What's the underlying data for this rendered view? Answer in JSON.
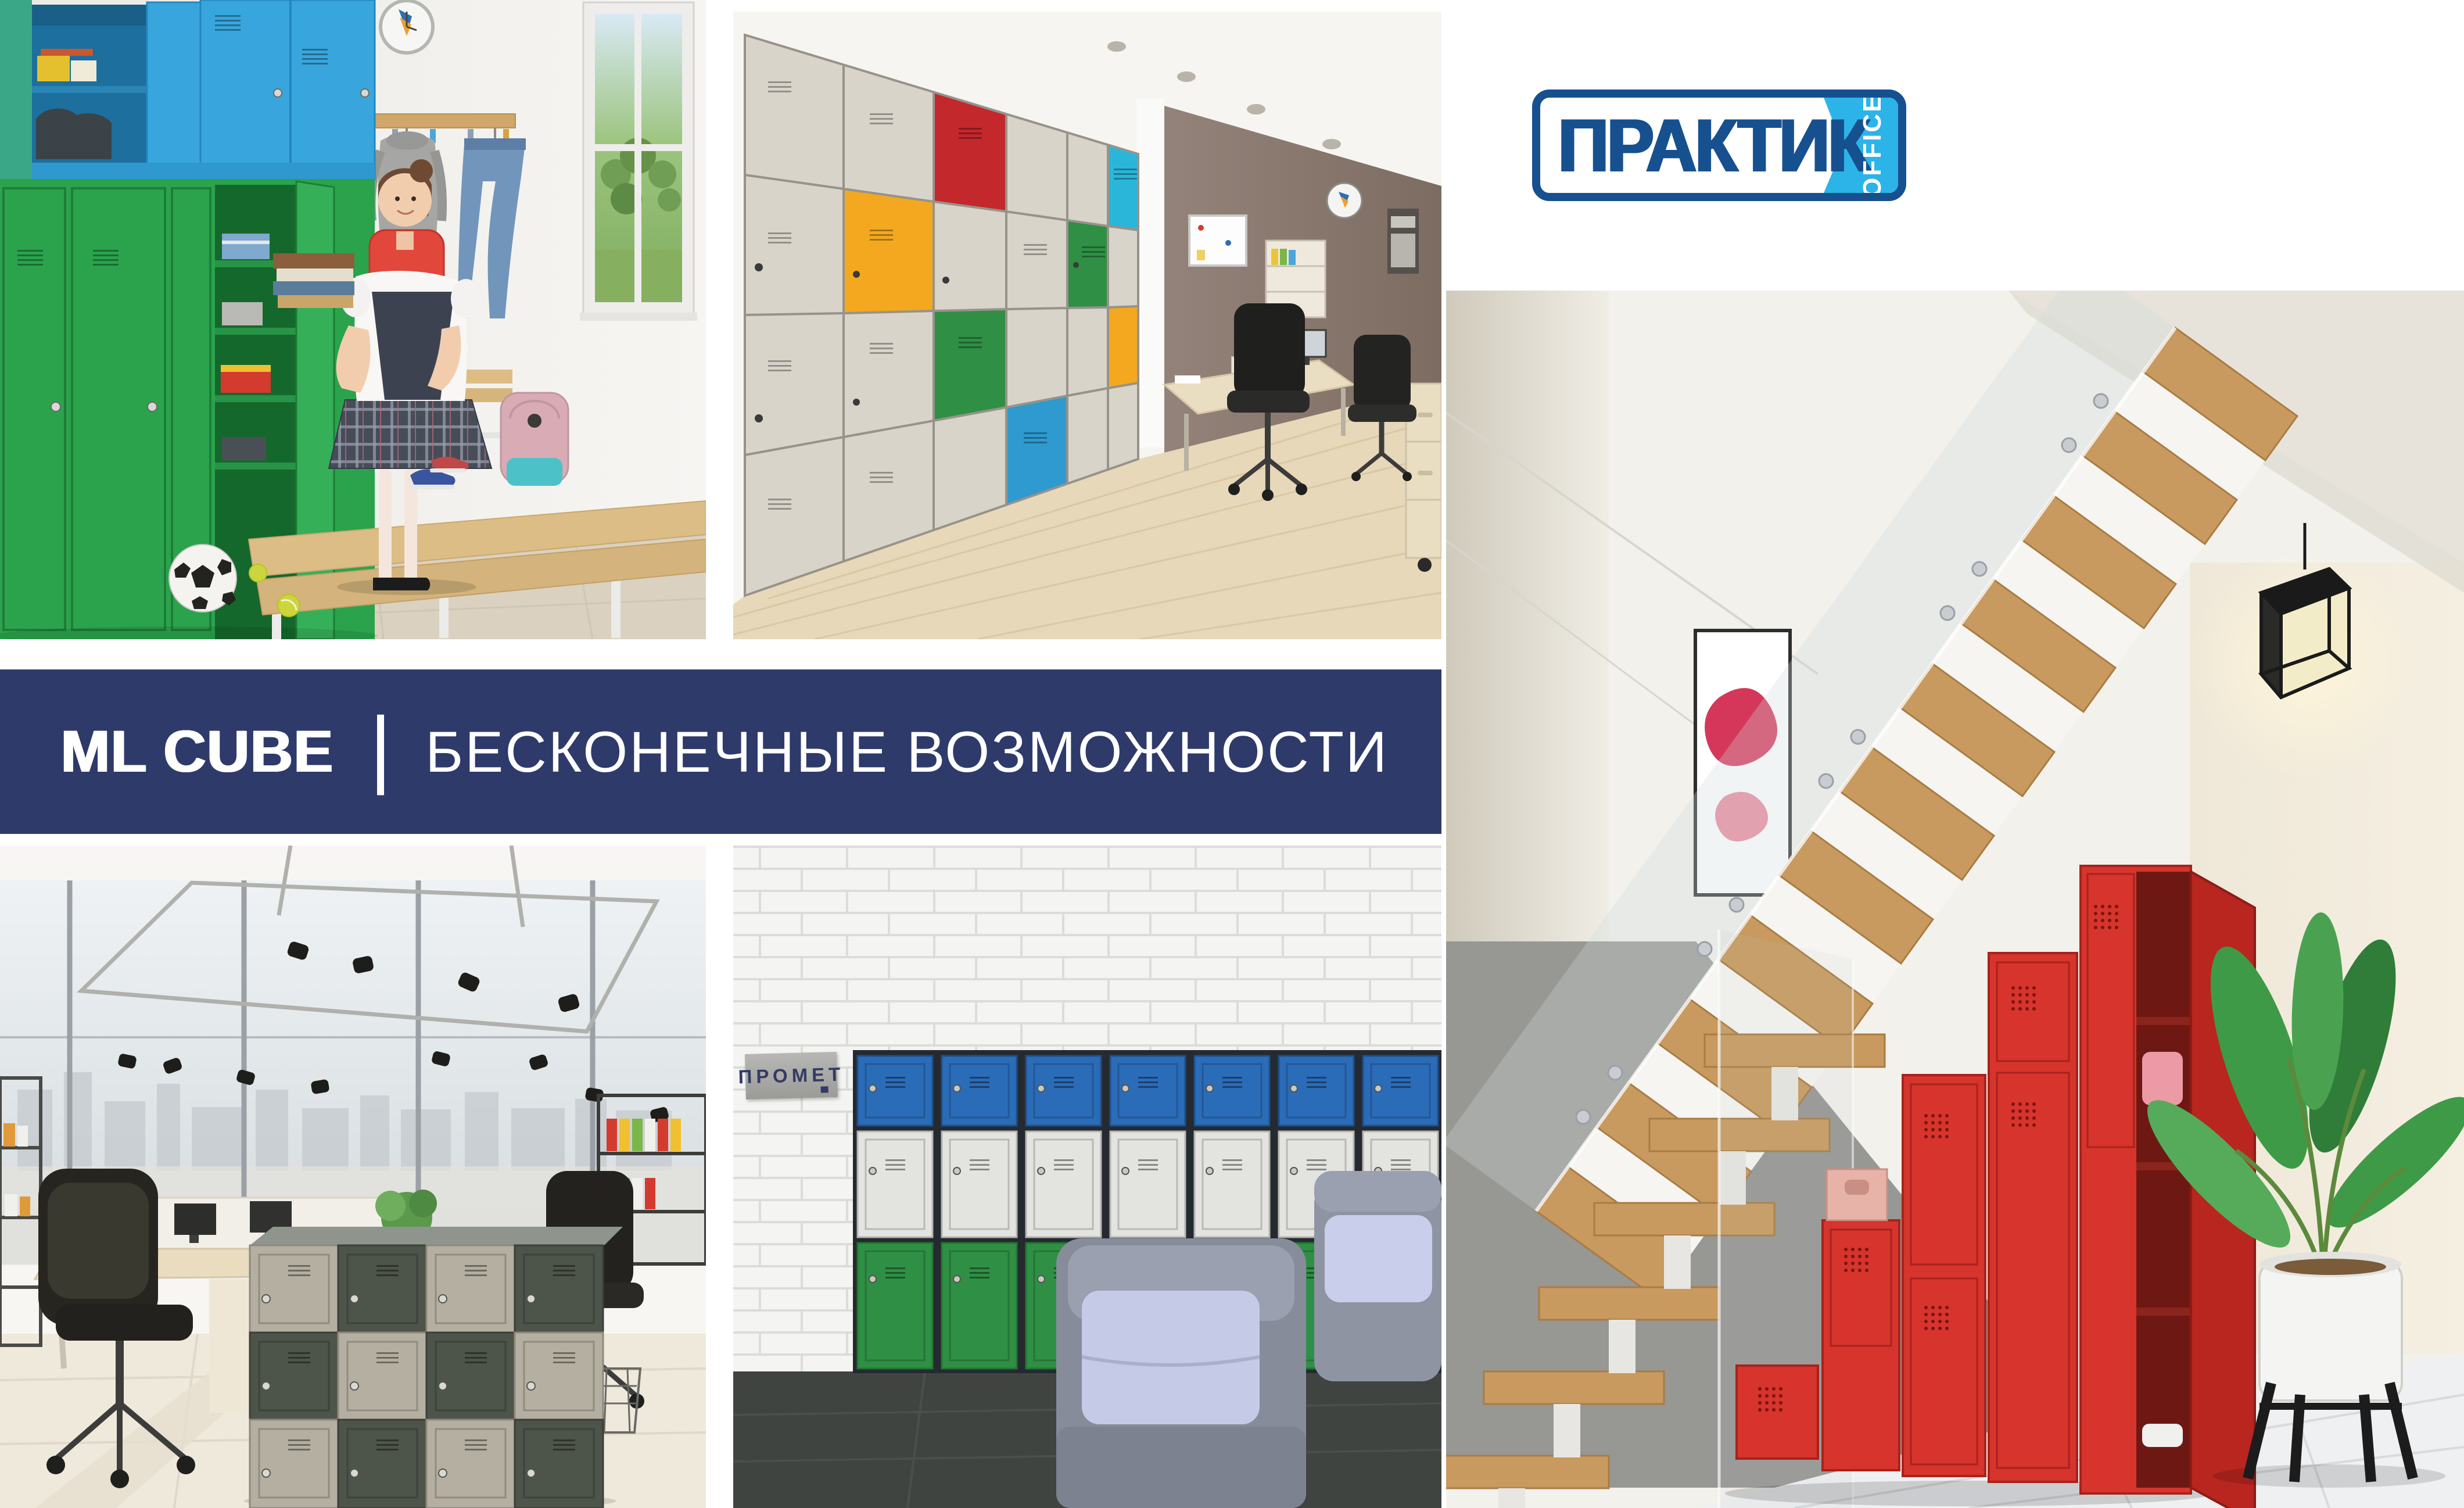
{
  "logo": {
    "brand": "ПРАКТИК",
    "suffix": "OFFICE"
  },
  "banner": {
    "product": "ML CUBE",
    "separator": "|",
    "tagline": "БЕСКОНЕЧНЫЕ ВОЗМОЖНОСТИ"
  },
  "sign": {
    "text": "ПРОМЕТ"
  },
  "colors": {
    "page-bg": "#ffffff",
    "banner-navy": "#2e3a6a",
    "logo-blue": "#17508f",
    "logo-light-blue": "#2cb4e8",
    "green-locker": "#2aa34c",
    "sky-blue-locker": "#38a6dd",
    "royal-blue-locker": "#2b6cb8",
    "teal-locker": "#2ab6d9",
    "red-locker": "#c2282c",
    "orange-locker": "#f3a81f",
    "forest-green-locker": "#2f8f45",
    "beige-locker": "#d8d4ca",
    "olive-locker": "#4d5449",
    "taupe-locker": "#b4afa0",
    "bright-red-locker": "#d6342c",
    "white-locker": "#e3e3e0",
    "sign-gray": "#a9a9a6",
    "wood": "#c89a5f",
    "dark-floor": "#404441",
    "brick": "#f4f4f2"
  }
}
